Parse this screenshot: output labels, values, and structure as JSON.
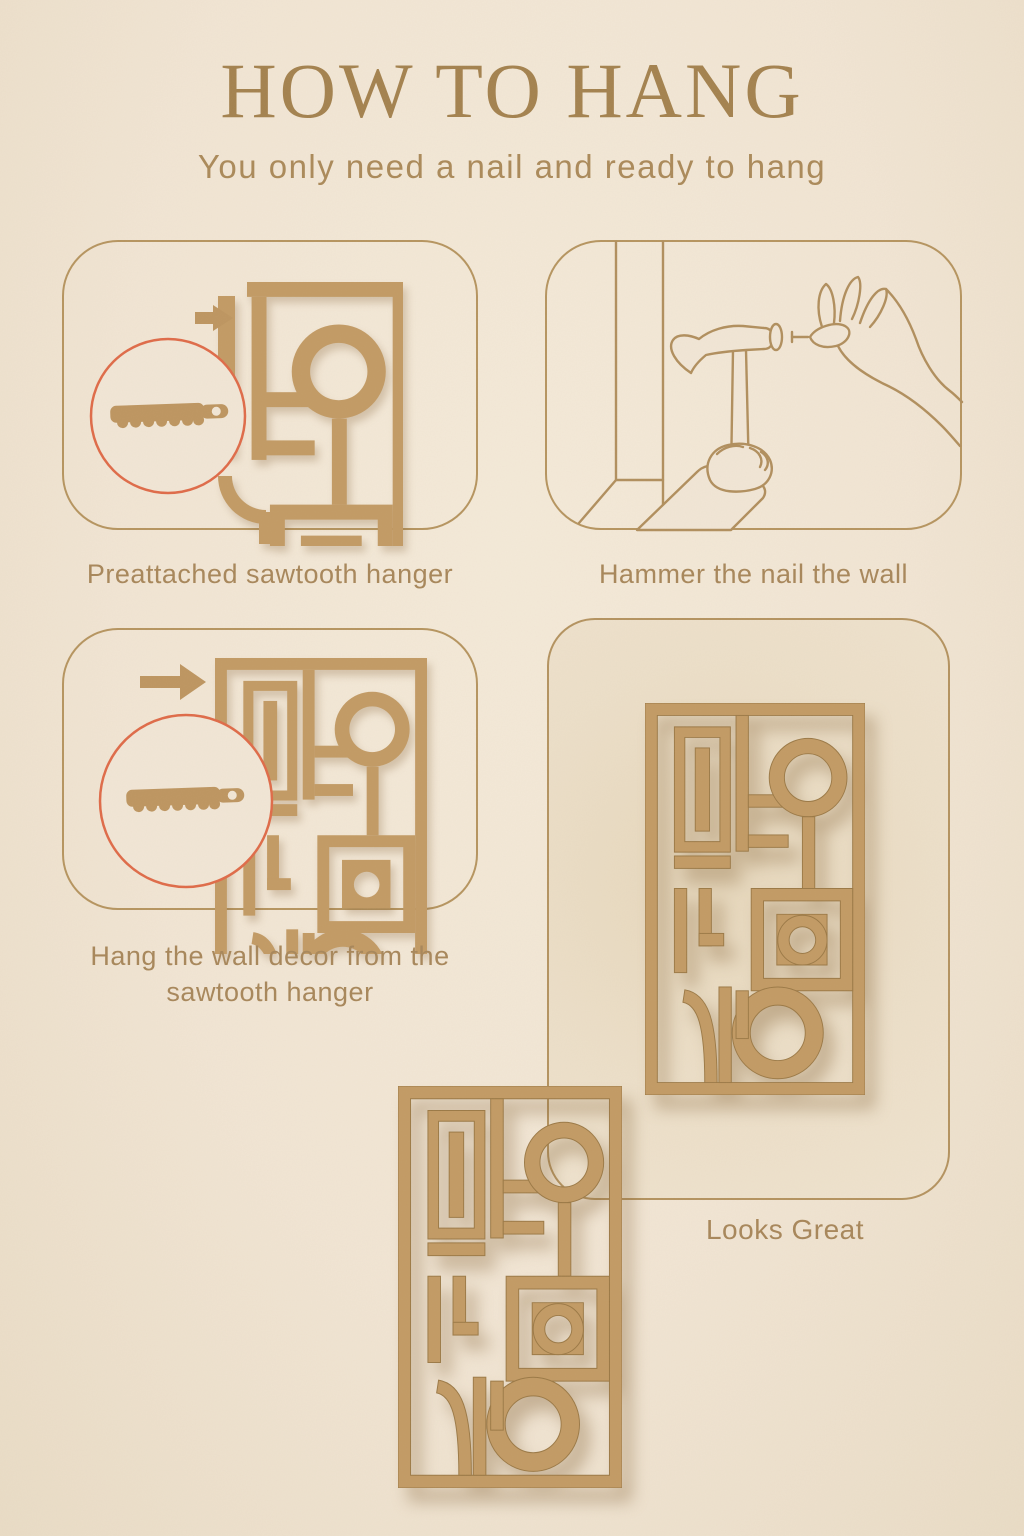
{
  "page": {
    "title": "HOW TO HANG",
    "subtitle": "You only need a nail and ready to hang"
  },
  "steps": [
    {
      "caption": "Preattached sawtooth hanger",
      "icons": [
        "arrow-right-icon",
        "magnifier-circle",
        "sawtooth-hanger-icon",
        "wall-decor-panel"
      ]
    },
    {
      "caption": "Hammer the nail the wall",
      "icons": [
        "wall-corner",
        "hammer-icon",
        "hand-holding-nail-icon"
      ]
    },
    {
      "caption": "Hang the wall decor from the sawtooth hanger",
      "icons": [
        "arrow-right-icon",
        "magnifier-circle",
        "sawtooth-hanger-icon",
        "wall-decor-panel"
      ]
    },
    {
      "caption": "Looks Great",
      "icons": [
        "wall-decor-panel"
      ]
    }
  ],
  "colors": {
    "background": "#f1e5d4",
    "decor_tan": "#c29a64",
    "line_art": "#b08e5d",
    "panel_border": "#b3925f",
    "magnifier_accent": "#df6a48",
    "title_text": "#a3814e",
    "body_text": "#a7865a",
    "inner_panel_fill": "#ecdfc9"
  }
}
